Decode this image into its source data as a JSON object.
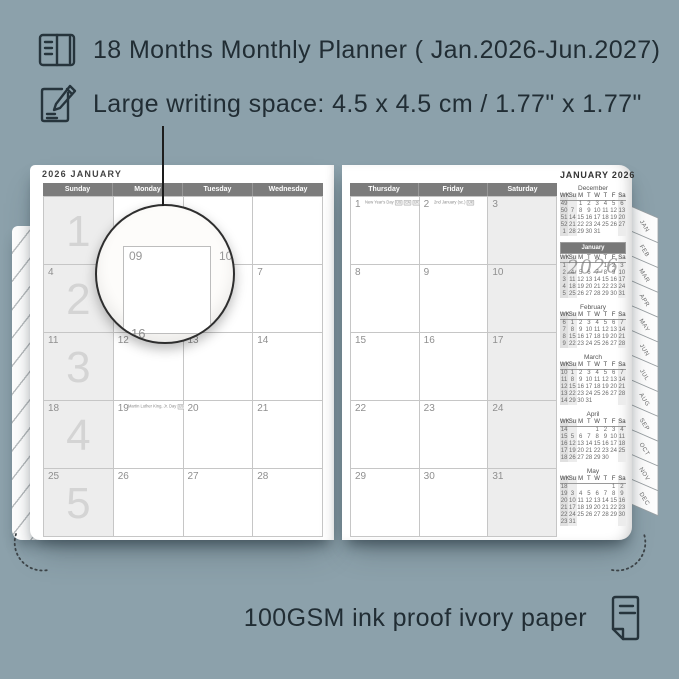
{
  "colors": {
    "background": "#8CA1AB",
    "page": "#ffffff",
    "header_bar": "#7c7c7c",
    "shaded_cell": "#ededed",
    "text_dark": "#212d34"
  },
  "header": {
    "line1": "18 Months Monthly Planner ( Jan.2026-Jun.2027)",
    "line2": "Large writing space: 4.5 x 4.5 cm / 1.77\" x 1.77\""
  },
  "footer": {
    "text": "100GSM ink proof ivory paper"
  },
  "left_page": {
    "title": "2026 JANUARY",
    "day_headers": [
      "Sunday",
      "Monday",
      "Tuesday",
      "Wednesday"
    ],
    "week_numbers": [
      "1",
      "2",
      "3",
      "4",
      "5"
    ],
    "rows": [
      [
        "",
        "",
        "",
        ""
      ],
      [
        "4",
        "5",
        "6",
        "7"
      ],
      [
        "11",
        "12",
        "13",
        "14"
      ],
      [
        "18",
        "19",
        "20",
        "21"
      ],
      [
        "25",
        "26",
        "27",
        "28"
      ]
    ],
    "holiday": {
      "row": 3,
      "col": 1,
      "text": "Martin Luther King, Jr. Day",
      "badge": "US"
    }
  },
  "right_page": {
    "day_headers": [
      "Thursday",
      "Friday",
      "Saturday"
    ],
    "rows": [
      [
        "1",
        "2",
        "3"
      ],
      [
        "8",
        "9",
        "10"
      ],
      [
        "15",
        "16",
        "17"
      ],
      [
        "22",
        "23",
        "24"
      ],
      [
        "29",
        "30",
        "31"
      ]
    ],
    "events": [
      {
        "row": 0,
        "col": 0,
        "label": "New Year's Day",
        "badges": [
          "US",
          "CA",
          "UK",
          "AU",
          "NZ"
        ]
      },
      {
        "row": 0,
        "col": 1,
        "label": "2nd January (sc.)",
        "badges": [
          "UK"
        ]
      }
    ]
  },
  "magnifier": {
    "cell_number": "09",
    "neighbor_right": "10",
    "neighbor_below": "16"
  },
  "sidebar": {
    "title": "JANUARY 2026",
    "watermark": "2026",
    "mini_header": [
      "WK",
      "Su",
      "M",
      "T",
      "W",
      "T",
      "F",
      "Sa"
    ],
    "months": [
      {
        "name": "December",
        "highlight": false,
        "weeks": [
          [
            "49",
            "",
            "1",
            "2",
            "3",
            "4",
            "5",
            "6"
          ],
          [
            "50",
            "7",
            "8",
            "9",
            "10",
            "11",
            "12",
            "13"
          ],
          [
            "51",
            "14",
            "15",
            "16",
            "17",
            "18",
            "19",
            "20"
          ],
          [
            "52",
            "21",
            "22",
            "23",
            "24",
            "25",
            "26",
            "27"
          ],
          [
            "1",
            "28",
            "29",
            "30",
            "31",
            "",
            "",
            ""
          ]
        ]
      },
      {
        "name": "January",
        "highlight": true,
        "weeks": [
          [
            "1",
            "",
            "",
            "",
            "",
            "1",
            "2",
            "3"
          ],
          [
            "2",
            "4",
            "5",
            "6",
            "7",
            "8",
            "9",
            "10"
          ],
          [
            "3",
            "11",
            "12",
            "13",
            "14",
            "15",
            "16",
            "17"
          ],
          [
            "4",
            "18",
            "19",
            "20",
            "21",
            "22",
            "23",
            "24"
          ],
          [
            "5",
            "25",
            "26",
            "27",
            "28",
            "29",
            "30",
            "31"
          ]
        ]
      },
      {
        "name": "February",
        "highlight": false,
        "weeks": [
          [
            "6",
            "1",
            "2",
            "3",
            "4",
            "5",
            "6",
            "7"
          ],
          [
            "7",
            "8",
            "9",
            "10",
            "11",
            "12",
            "13",
            "14"
          ],
          [
            "8",
            "15",
            "16",
            "17",
            "18",
            "19",
            "20",
            "21"
          ],
          [
            "9",
            "22",
            "23",
            "24",
            "25",
            "26",
            "27",
            "28"
          ]
        ]
      },
      {
        "name": "March",
        "highlight": false,
        "weeks": [
          [
            "10",
            "1",
            "2",
            "3",
            "4",
            "5",
            "6",
            "7"
          ],
          [
            "11",
            "8",
            "9",
            "10",
            "11",
            "12",
            "13",
            "14"
          ],
          [
            "12",
            "15",
            "16",
            "17",
            "18",
            "19",
            "20",
            "21"
          ],
          [
            "13",
            "22",
            "23",
            "24",
            "25",
            "26",
            "27",
            "28"
          ],
          [
            "14",
            "29",
            "30",
            "31",
            "",
            "",
            "",
            ""
          ]
        ]
      },
      {
        "name": "April",
        "highlight": false,
        "weeks": [
          [
            "14",
            "",
            "",
            "",
            "1",
            "2",
            "3",
            "4"
          ],
          [
            "15",
            "5",
            "6",
            "7",
            "8",
            "9",
            "10",
            "11"
          ],
          [
            "16",
            "12",
            "13",
            "14",
            "15",
            "16",
            "17",
            "18"
          ],
          [
            "17",
            "19",
            "20",
            "21",
            "22",
            "23",
            "24",
            "25"
          ],
          [
            "18",
            "26",
            "27",
            "28",
            "29",
            "30",
            "",
            ""
          ]
        ]
      },
      {
        "name": "May",
        "highlight": false,
        "weeks": [
          [
            "18",
            "",
            "",
            "",
            "",
            "",
            "1",
            "2"
          ],
          [
            "19",
            "3",
            "4",
            "5",
            "6",
            "7",
            "8",
            "9"
          ],
          [
            "20",
            "10",
            "11",
            "12",
            "13",
            "14",
            "15",
            "16"
          ],
          [
            "21",
            "17",
            "18",
            "19",
            "20",
            "21",
            "22",
            "23"
          ],
          [
            "22",
            "24",
            "25",
            "26",
            "27",
            "28",
            "29",
            "30"
          ],
          [
            "23",
            "31",
            "",
            "",
            "",
            "",
            "",
            ""
          ]
        ]
      }
    ]
  },
  "tabs": [
    "JAN",
    "FEB",
    "MAR",
    "APR",
    "MAY",
    "JUN",
    "JUL",
    "AUG",
    "SEP",
    "OCT",
    "NOV",
    "DEC"
  ]
}
